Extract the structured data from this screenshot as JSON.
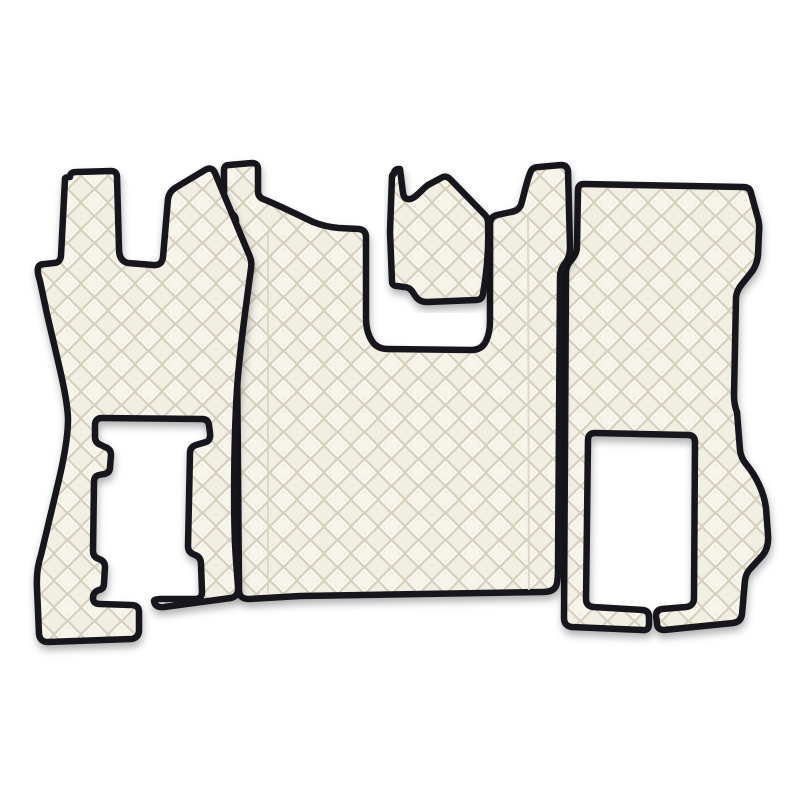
{
  "image": {
    "alt": "Three-piece quilted eco-leather truck floor mat set in cream with black piped edges on a white background",
    "background": "#ffffff"
  },
  "product": {
    "kind": "truck-floor-mat-set",
    "piece_count": 4,
    "pieces": [
      {
        "id": "driver-side-mat",
        "label": "Driver side mat with seat-base cutout and bottom slit"
      },
      {
        "id": "engine-tunnel-mat",
        "label": "Center engine tunnel mat with engine hump notch and two top tabs"
      },
      {
        "id": "engine-cover-mat",
        "label": "Small engine cover piece"
      },
      {
        "id": "passenger-side-mat",
        "label": "Passenger side mat with seat-base cutout and bottom slit"
      }
    ],
    "material": "quilted eco-leather",
    "pattern": {
      "style": "diamond-quilt",
      "cell_px": 27
    }
  },
  "colors": {
    "leather_base": "#f1eee2",
    "leather_highlight": "#fcfaf4",
    "leather_crease": "#d6d0bd",
    "quilt_center": "#f7f4ea",
    "piping": "#17171b",
    "seam": "#d9d3c1",
    "shadow": "rgba(0,0,0,0.30)",
    "background": "#ffffff"
  }
}
